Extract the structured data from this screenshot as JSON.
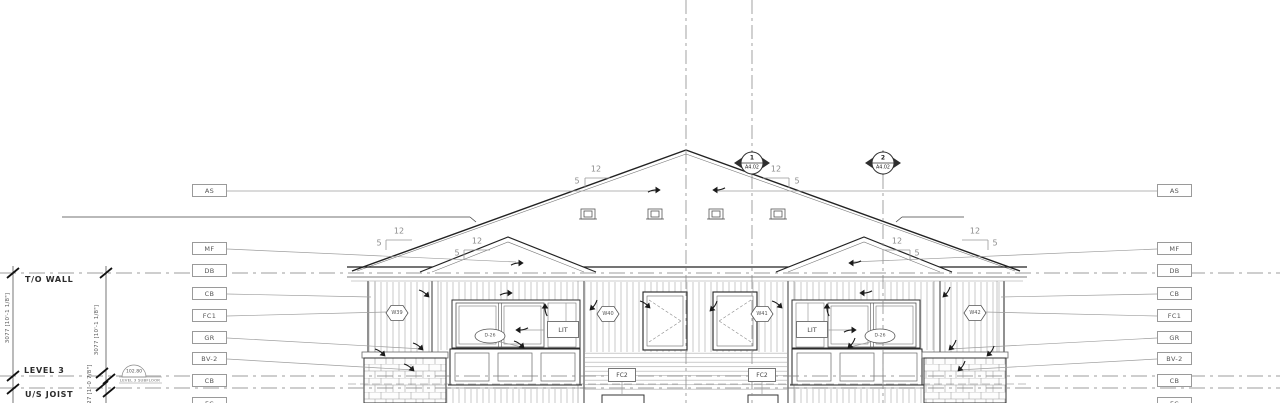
{
  "levels": {
    "t_o_wall": "T/O WALL",
    "level_3": "LEVEL 3",
    "u_s_joist": "U/S JOIST"
  },
  "elevation_marker": {
    "value": "102.80",
    "label": "LEVEL 3 SUBFLOOR"
  },
  "dimensions": {
    "left_outer": "3077 [10'-1 1/8\"]",
    "left_inner": "3077 [10'-1 1/8\"]",
    "joist_gap": "327 [1'-0 7/8\"]"
  },
  "material_tags": {
    "left": [
      "AS",
      "MF",
      "DB",
      "CB",
      "FC1",
      "GR",
      "BV-2",
      "CB",
      "FC"
    ],
    "right": [
      "AS",
      "MF",
      "DB",
      "CB",
      "FC1",
      "GR",
      "BV-2",
      "CB",
      "FC"
    ]
  },
  "section_markers": [
    {
      "number": "1",
      "sheet": "A4.02"
    },
    {
      "number": "2",
      "sheet": "A4.02"
    }
  ],
  "roof_slopes": [
    {
      "run": "12",
      "rise": "5"
    },
    {
      "run": "12",
      "rise": "5"
    },
    {
      "run": "12",
      "rise": "5"
    },
    {
      "run": "12",
      "rise": "5"
    },
    {
      "run": "12",
      "rise": "5"
    },
    {
      "run": "12",
      "rise": "5"
    }
  ],
  "window_tags": [
    "W39",
    "W40",
    "W41",
    "W42"
  ],
  "door_tags": [
    "D-26",
    "D-26"
  ],
  "light_labels": [
    "LIT",
    "LIT"
  ],
  "panel_tags": [
    "FC2",
    "FC2"
  ]
}
